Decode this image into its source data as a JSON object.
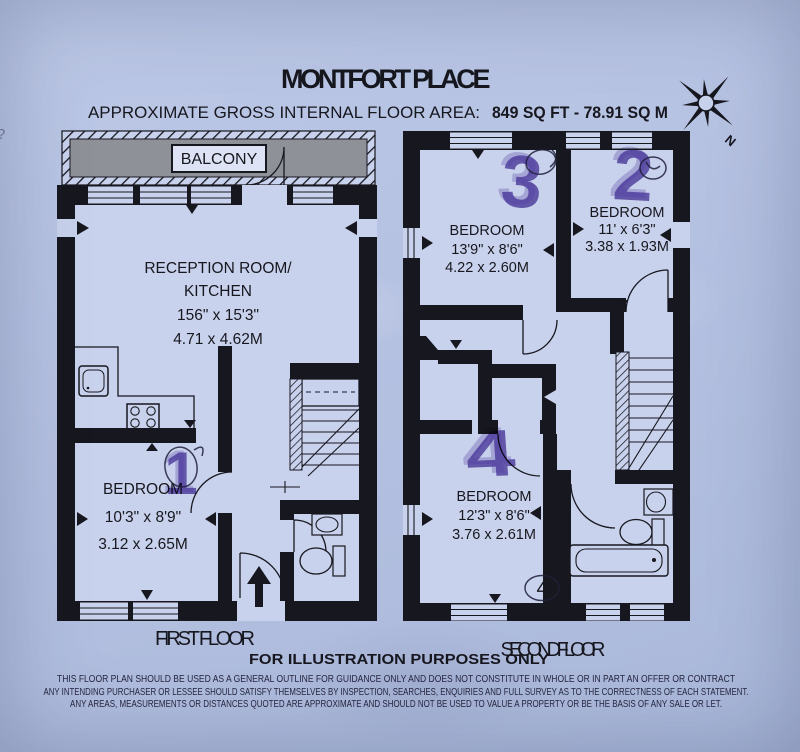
{
  "page": {
    "title": "MONTFORT PLACE",
    "subtitle_label": "APPROXIMATE GROSS INTERNAL FLOOR AREA:",
    "subtitle_value": "849 SQ FT - 78.91 SQ M",
    "illustration_note": "FOR ILLUSTRATION PURPOSES ONLY",
    "disclaimer1": "THIS FLOOR PLAN SHOULD BE USED AS A GENERAL OUTLINE FOR GUIDANCE ONLY AND DOES NOT CONSTITUTE IN WHOLE OR IN PART AN OFFER OR CONTRACT",
    "disclaimer2": "ANY INTENDING PURCHASER OR LESSEE SHOULD SATISFY THEMSELVES BY INSPECTION, SEARCHES, ENQUIRIES AND FULL SURVEY AS TO THE CORRECTNESS OF EACH STATEMENT.",
    "disclaimer3": "ANY AREAS, MEASUREMENTS OR DISTANCES QUOTED ARE APPROXIMATE AND SHOULD NOT BE USED TO VALUE A PROPERTY OR BE THE BASIS OF ANY SALE OR LET.",
    "edge_mark": "?"
  },
  "compass": {
    "north_label": "N"
  },
  "colors": {
    "paper": "#b6c2e2",
    "ink": "#17171f",
    "balcony_gray": "#8f9198",
    "marker_purple": "#5a3fa5"
  },
  "first_floor": {
    "label": "FIRST FLOOR",
    "balcony": "BALCONY",
    "reception": {
      "name1": "RECEPTION ROOM/",
      "name2": "KITCHEN",
      "imperial": "156\" x 15'3\"",
      "metric": "4.71 x 4.62M"
    },
    "bedroom": {
      "name": "BEDROOM",
      "imperial": "10'3\" x 8'9\"",
      "metric": "3.12 x 2.65M",
      "marker": "1"
    }
  },
  "second_floor": {
    "label": "SECOND FLOOR",
    "bedroom3": {
      "name": "BEDROOM",
      "imperial": "13'9\" x 8'6\"",
      "metric": "4.22 x 2.60M",
      "marker": "3"
    },
    "bedroom2": {
      "name": "BEDROOM",
      "imperial": "11' x 6'3\"",
      "metric": "3.38 x 1.93M",
      "marker": "2"
    },
    "bedroom4": {
      "name": "BEDROOM",
      "imperial": "12'3\" x 8'6\"",
      "metric": "3.76 x 2.61M",
      "marker": "4",
      "circled_note": "4"
    }
  }
}
